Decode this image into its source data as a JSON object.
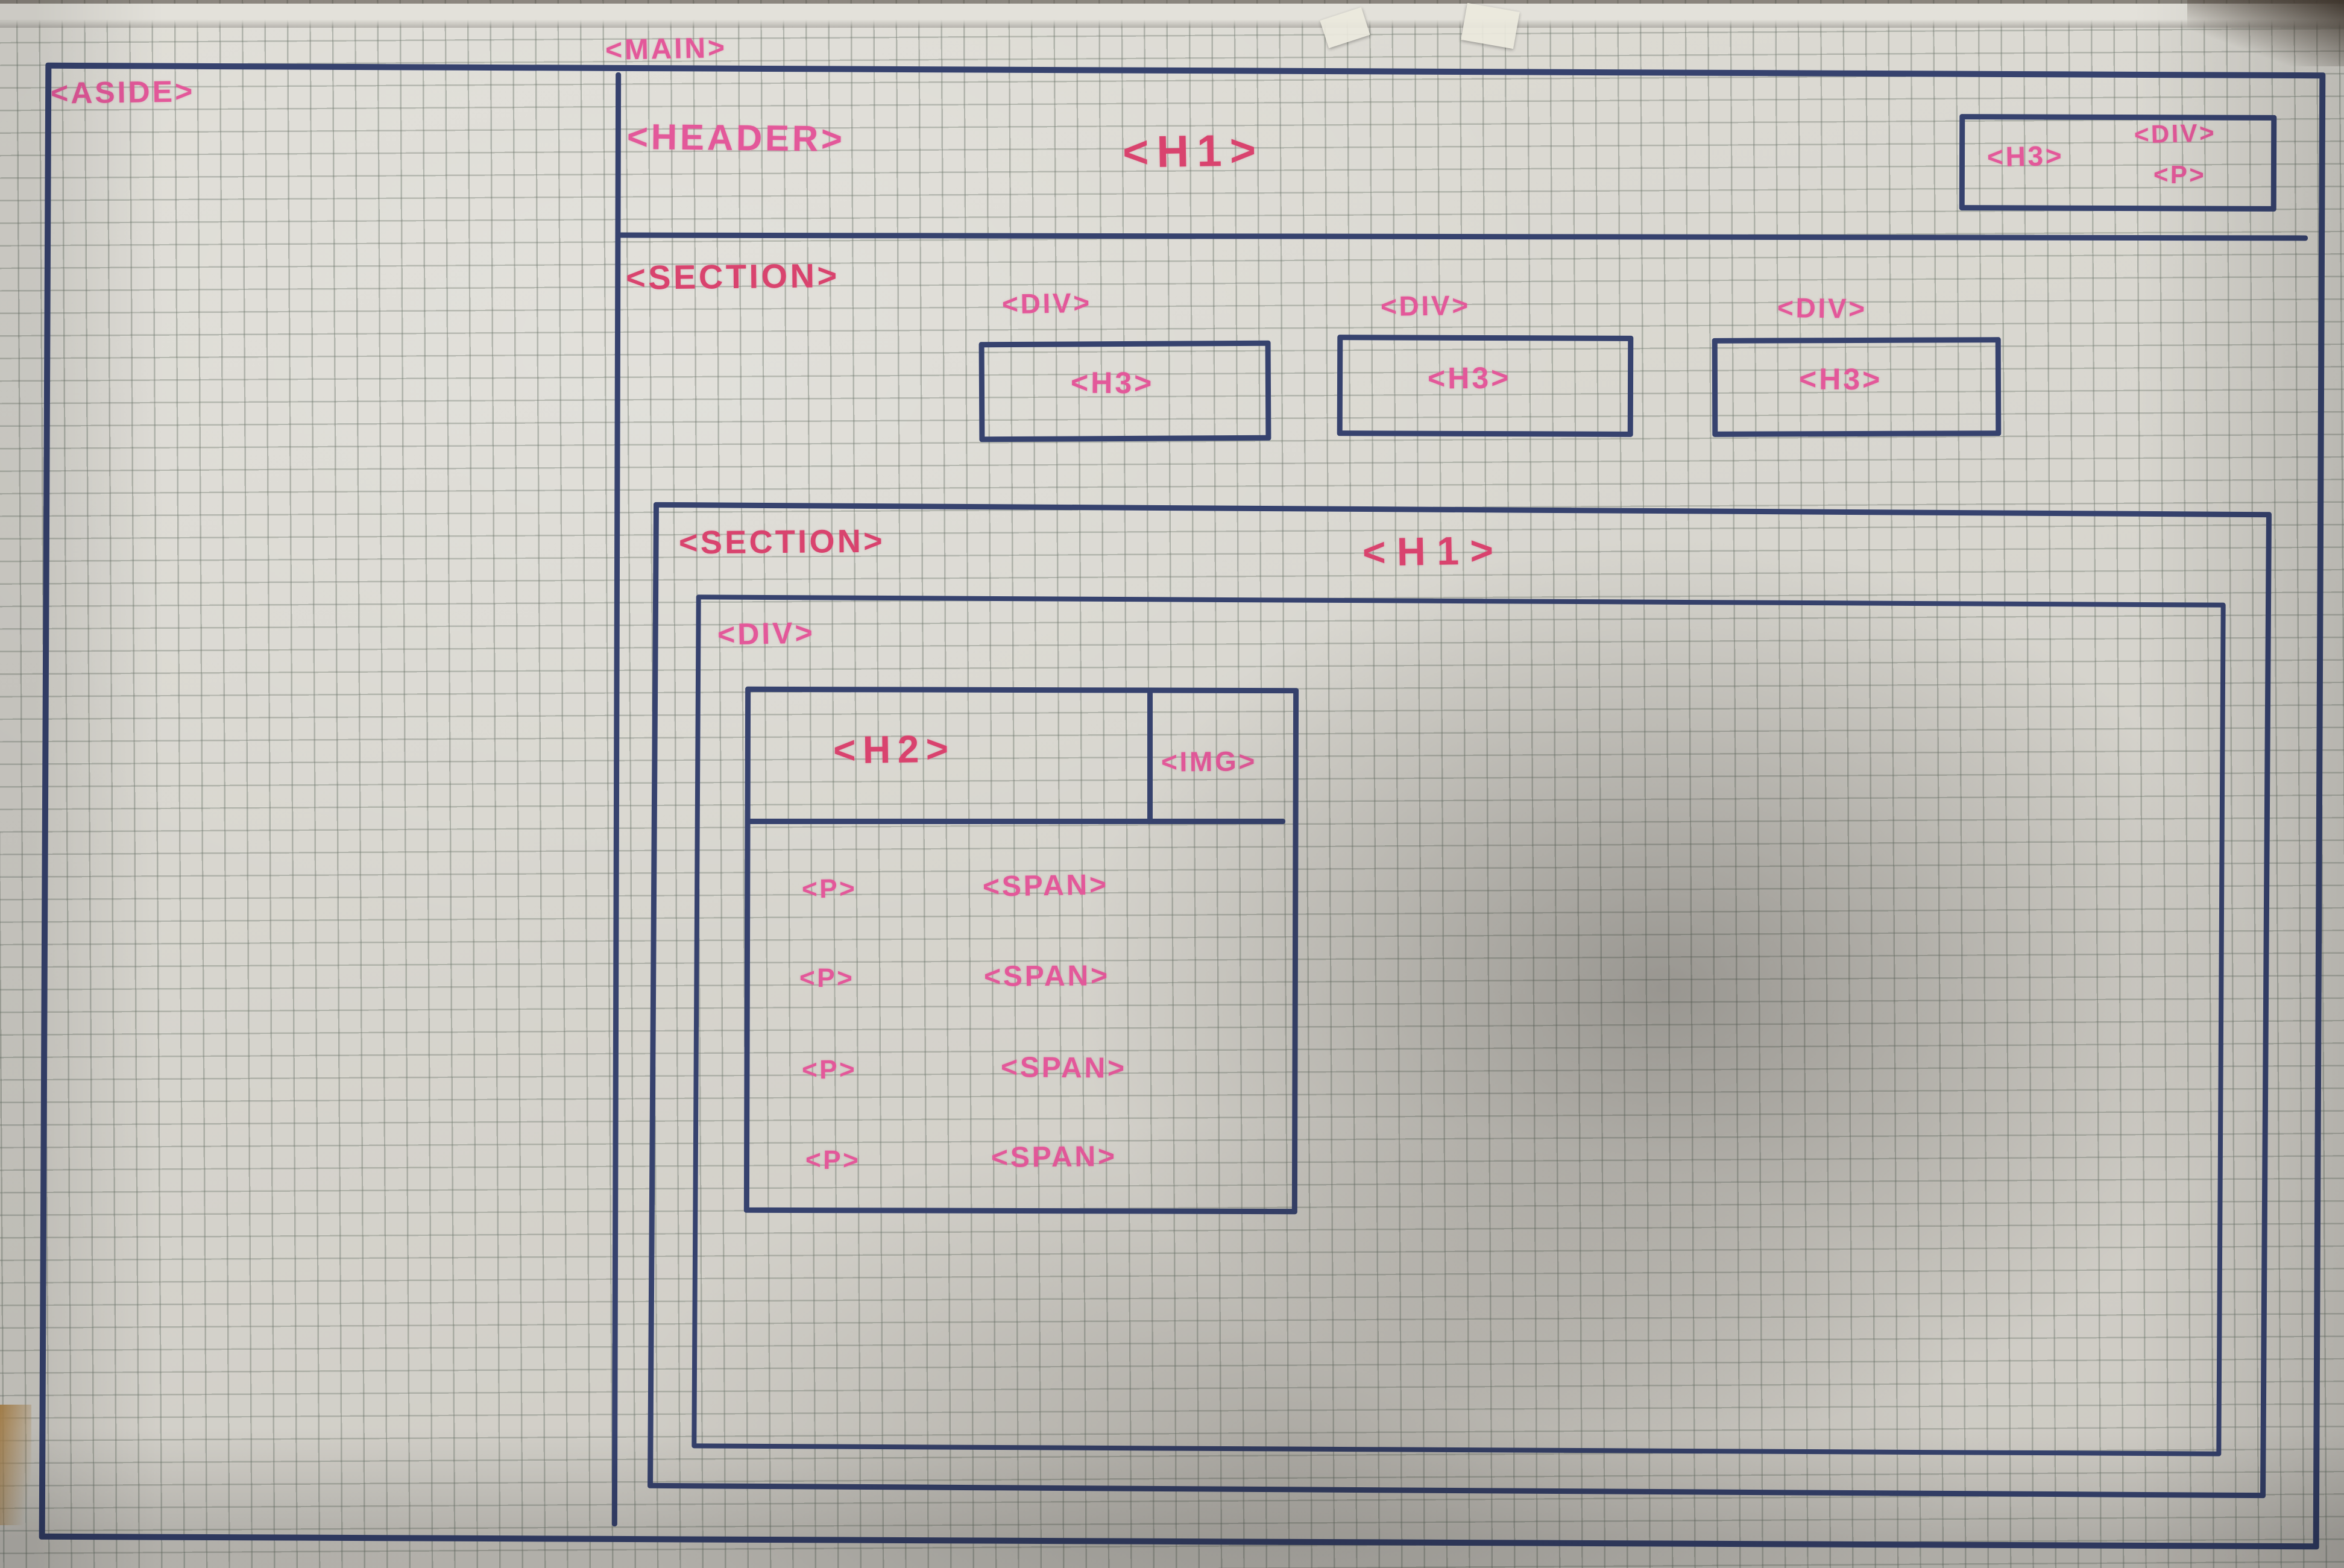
{
  "meta": {
    "description": "Hand-drawn HTML wireframe sketch in blue pen and pink marker on graph paper"
  },
  "colors": {
    "pen": "#36426e",
    "marker_pink": "#e3589a",
    "marker_red": "#d9436e",
    "paper": "#d8d6cf"
  },
  "wireframe": {
    "aside": {
      "label": "<ASIDE>"
    },
    "main": {
      "label": "<MAIN>",
      "header": {
        "label": "<HEADER>",
        "h1": "<H1>",
        "widget": {
          "h3": "<H3>",
          "div": "<DIV>",
          "p": "<P>"
        }
      },
      "section1": {
        "label": "<SECTION>",
        "cards": [
          {
            "div": "<DIV>",
            "h3": "<H3>"
          },
          {
            "div": "<DIV>",
            "h3": "<H3>"
          },
          {
            "div": "<DIV>",
            "h3": "<H3>"
          }
        ]
      },
      "section2": {
        "label": "<SECTION>",
        "h1": "<H1>",
        "content_div": {
          "label": "<DIV>",
          "card": {
            "h2": "<H2>",
            "img": "<IMG>",
            "rows": [
              {
                "p": "<P>",
                "span": "<SPAN>"
              },
              {
                "p": "<P>",
                "span": "<SPAN>"
              },
              {
                "p": "<P>",
                "span": "<SPAN>"
              },
              {
                "p": "<P>",
                "span": "<SPAN>"
              }
            ]
          }
        }
      }
    }
  }
}
